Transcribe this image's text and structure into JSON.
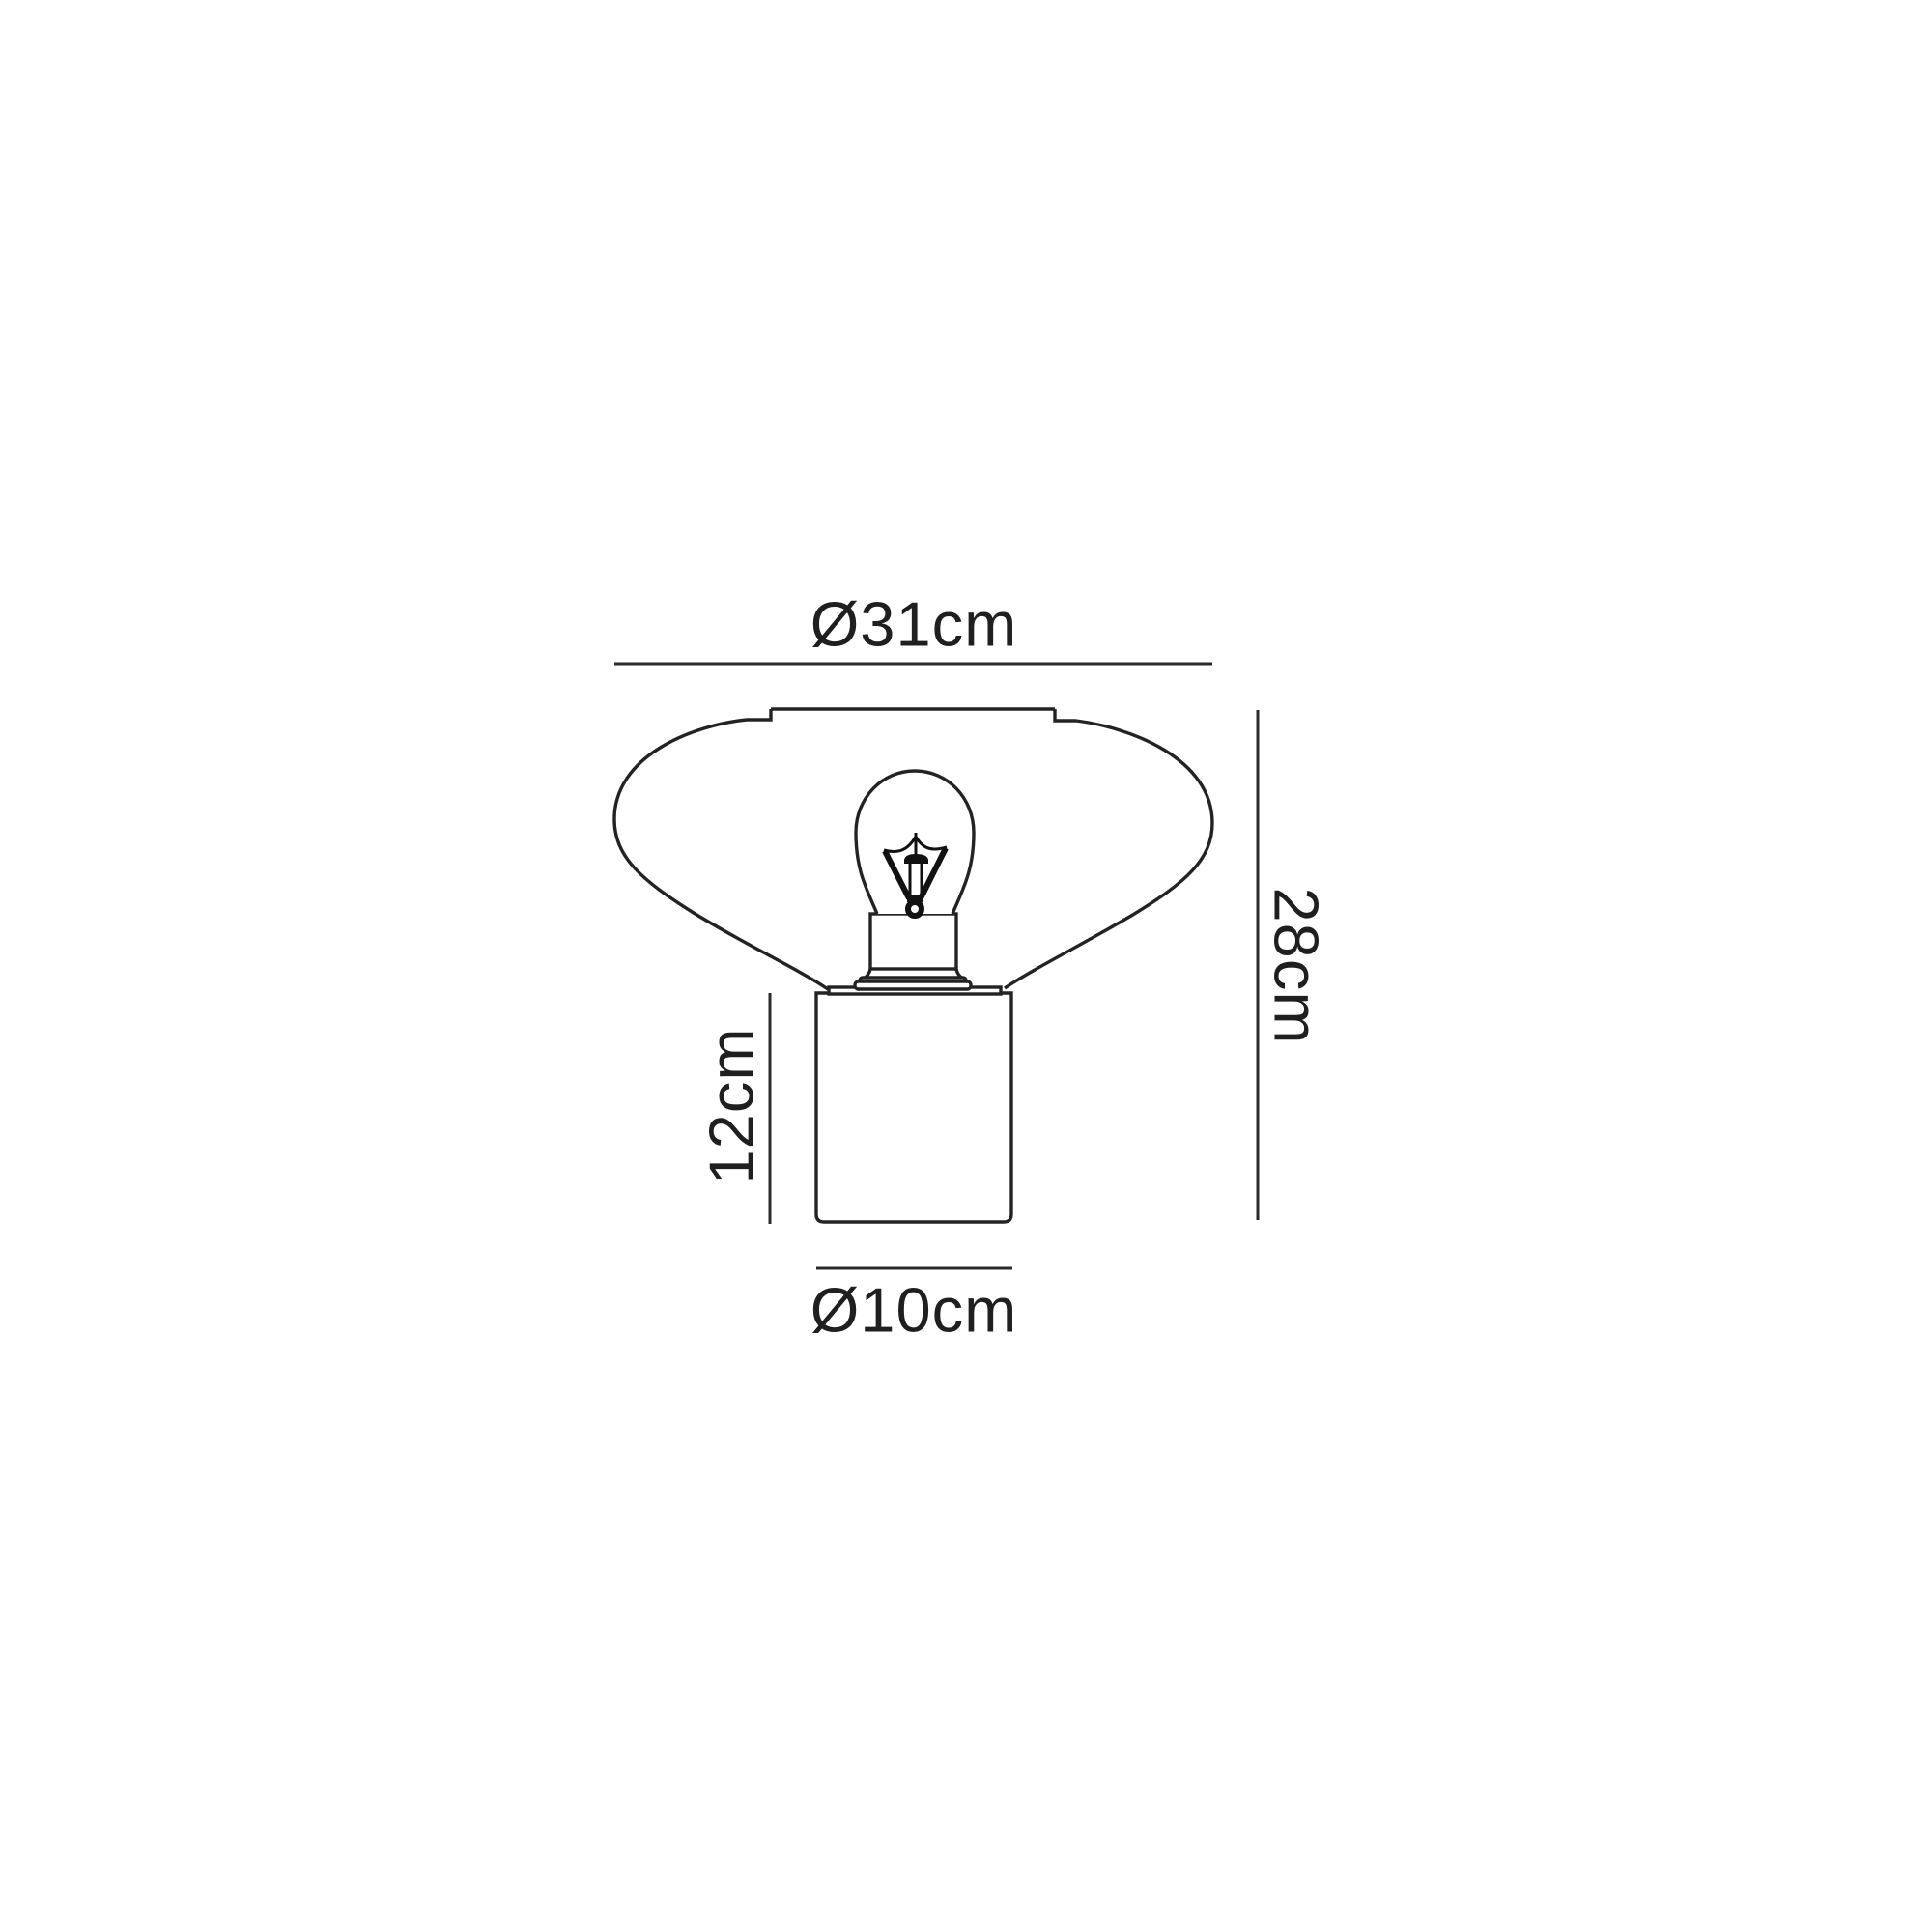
{
  "diagram": {
    "title": "table-lamp-dimension-drawing",
    "product": "Table lamp with wide tapered shade, exposed filament bulb and cylindrical base",
    "dimensions": {
      "shade_diameter": "Ø31cm",
      "total_height": "28cm",
      "base_height": "12cm",
      "base_diameter": "Ø10cm"
    },
    "colors": {
      "line": "#232323",
      "text": "#1f1f1f",
      "background": "#ffffff"
    }
  }
}
